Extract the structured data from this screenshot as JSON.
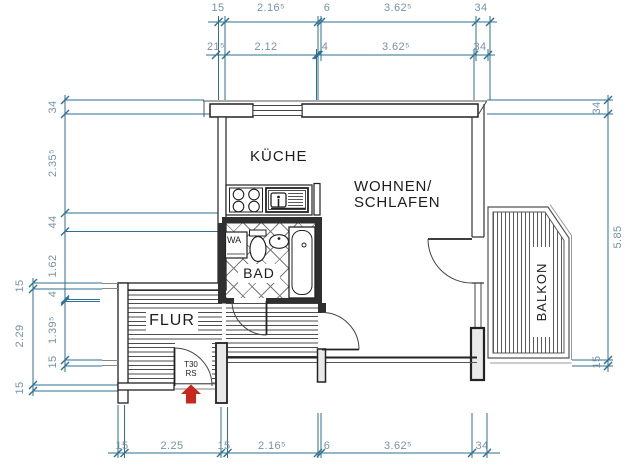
{
  "rooms": {
    "kueche": "KÜCHE",
    "wohnen_line1": "WOHNEN/",
    "wohnen_line2": "SCHLAFEN",
    "bad": "BAD",
    "flur": "FLUR",
    "balkon": "BALKON"
  },
  "fixtures": {
    "washing_machine": "WA",
    "entrance_door_line1": "T30",
    "entrance_door_line2": "RS"
  },
  "dims": {
    "top_outer": [
      "15",
      "2.16⁵",
      "6",
      "3.62⁵",
      "34"
    ],
    "top_inner": [
      "21⁵",
      "2.12",
      "4",
      "3.62⁵",
      "34"
    ],
    "bottom": [
      "15",
      "2.25",
      "15",
      "2.16⁵",
      "6",
      "3.62⁵",
      "34"
    ],
    "left_inner": [
      "34",
      "2.35⁵",
      "44",
      "1.62",
      "4",
      "1.39⁵",
      "15"
    ],
    "left_outer": [
      "15",
      "2.29",
      "15"
    ],
    "right_chain": [
      "34",
      "5.85",
      "15"
    ]
  },
  "colors": {
    "dimension_line": "#2e6f92",
    "dimension_text": "#7893a4",
    "wall_dark": "#2f2f2f",
    "entrance_arrow": "#c8271d"
  }
}
